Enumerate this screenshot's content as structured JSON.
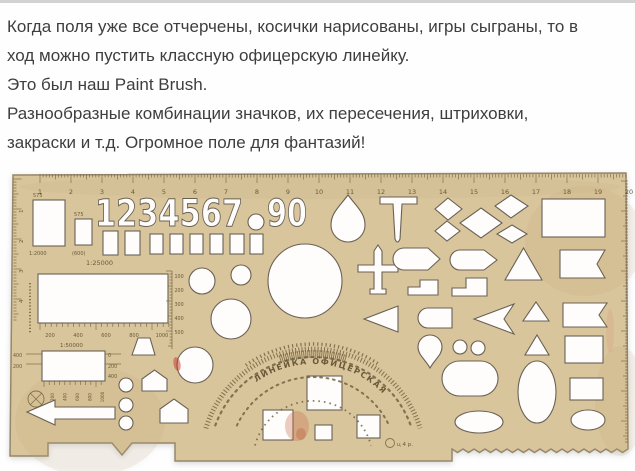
{
  "article": {
    "lines": [
      "Когда поля уже все отчерчены, косички нарисованы, игры сыграны, то в",
      "ход можно пустить классную офицерскую линейку.",
      "Это был наш Paint Brush.",
      "Разнообразные комбинации значков, их пересечения, штриховки,",
      "закраски и т.д. Огромное поле для фантазий!"
    ]
  },
  "stencil": {
    "colors": {
      "plastic": "#d9c59c",
      "plastic_edge": "#97876a",
      "cutout": "#fefdfb",
      "cutout_stroke": "#6a6155",
      "engraving": "#6d5d3c",
      "stain_red": "#c96a4a"
    },
    "arc_title": "ЛИНЕЙКА  ОФИЦЕРСКАЯ",
    "price_mark": "ц 4 р.",
    "body_path": "M13,4 L626,2 L628,278 l-5.5,3.5 l-5.5,-3.5 l-5.5,3.5 l-5.5,-3.5 l-5.5,3.5 l-5.5,-3.5 l-5.5,3.5 l-5.5,-3.5 l-5.5,3.5 l-5.5,-3.5 l-5.5,3.5 l-5.5,-3.5 l-5.5,3.5 l-5.5,-3.5 l-5.5,3.5 l-5.5,-3.5 l-5.5,3.5 l-5.5,-3.5 l-5.5,3.5 l-5.5,-3.5 l-5.5,3.5 l-5.5,-3.5 l-5.5,3.5 l-5.5,-3.5 l-5.5,3.5 l-5.5,-3.5 l-5.5,3.5 l-5.5,-3.5 l-5.5,3.5 l-5.5,-3.5 l-5.5,3.5 l-5.5,-3.5 L452,290 L175,290 L175,272 L132,272 L122,284 L112,272 L48,272 L48,285 L10,285 Z",
    "shading": [
      {
        "cx": 90,
        "cy": 250,
        "rx": 75,
        "ry": 55,
        "f": "#c2a878",
        "o": 0.15
      },
      {
        "cx": 585,
        "cy": 70,
        "rx": 60,
        "ry": 55,
        "f": "#c2a878",
        "o": 0.15
      },
      {
        "cx": 320,
        "cy": 16,
        "rx": 300,
        "ry": 12,
        "f": "#bfa678",
        "o": 0.12
      },
      {
        "cx": 620,
        "cy": 230,
        "rx": 25,
        "ry": 55,
        "f": "#c2a878",
        "o": 0.15
      }
    ],
    "cutouts": [
      {
        "t": "rect",
        "n": "window-large",
        "x": 33,
        "y": 29,
        "w": 32,
        "h": 46
      },
      {
        "t": "rect",
        "n": "window-small",
        "x": 75,
        "y": 48,
        "w": 17,
        "h": 26
      },
      {
        "t": "text",
        "n": "digits-1-7",
        "x": 95,
        "y": 55,
        "s": 37,
        "tl": 148,
        "str": "1234567"
      },
      {
        "t": "circle",
        "n": "degree-circle",
        "cx": 256,
        "cy": 51,
        "r": 8
      },
      {
        "t": "text",
        "n": "digits-9-0",
        "x": 267,
        "y": 55,
        "s": 37,
        "tl": 40,
        "str": "90"
      },
      {
        "t": "rect",
        "x": 103,
        "y": 60,
        "w": 15,
        "h": 24
      },
      {
        "t": "rect",
        "x": 125,
        "y": 60,
        "w": 15,
        "h": 24
      },
      {
        "t": "rect",
        "x": 150,
        "y": 63,
        "w": 13,
        "h": 20
      },
      {
        "t": "rect",
        "x": 170,
        "y": 63,
        "w": 13,
        "h": 20
      },
      {
        "t": "rect",
        "x": 190,
        "y": 63,
        "w": 13,
        "h": 20
      },
      {
        "t": "rect",
        "x": 210,
        "y": 63,
        "w": 13,
        "h": 20
      },
      {
        "t": "rect",
        "x": 230,
        "y": 63,
        "w": 14,
        "h": 20
      },
      {
        "t": "rect",
        "x": 250,
        "y": 63,
        "w": 13,
        "h": 20
      },
      {
        "t": "rect",
        "n": "map-frame-25000",
        "x": 38,
        "y": 103,
        "w": 130,
        "h": 49
      },
      {
        "t": "rect",
        "n": "map-frame-50000",
        "x": 42,
        "y": 180,
        "w": 63,
        "h": 30
      },
      {
        "t": "poly",
        "n": "arrow-left",
        "pts": "27,241 55,229 55,236 115,236 115,248 55,248 55,254"
      },
      {
        "t": "circle",
        "cx": 126,
        "cy": 214,
        "r": 7
      },
      {
        "t": "circle",
        "cx": 126,
        "cy": 234,
        "r": 7
      },
      {
        "t": "circle",
        "cx": 126,
        "cy": 252,
        "r": 7
      },
      {
        "t": "poly",
        "n": "trapezoid",
        "pts": "138,167 150,167 155,184 132,184"
      },
      {
        "t": "poly",
        "n": "house-small",
        "pts": "142,208 154.5,199 167,208 167,220 142,220"
      },
      {
        "t": "poly",
        "n": "house-large",
        "pts": "160,238 174,228 188,238 188,252 160,252"
      },
      {
        "t": "circle",
        "cx": 195,
        "cy": 194,
        "r": 18
      },
      {
        "t": "circle",
        "cx": 202,
        "cy": 110,
        "r": 13
      },
      {
        "t": "circle",
        "cx": 241,
        "cy": 104,
        "r": 10
      },
      {
        "t": "circle",
        "cx": 231,
        "cy": 148,
        "r": 20
      },
      {
        "t": "circle",
        "n": "circle-large",
        "cx": 305,
        "cy": 110,
        "r": 37
      },
      {
        "t": "path",
        "n": "teardrop-up",
        "d": "M348,24 C339,36 331,42 331,54 A17,17 0 1 0 365,54 C365,42 357,36 348,24 Z"
      },
      {
        "t": "path",
        "n": "t-mark",
        "d": "M380,26 H417 V33 H402 L400,68 Q397.5,74 395,68 L393,33 H380 Z"
      },
      {
        "t": "poly",
        "n": "diamond",
        "pts": "448,27 462,38 448,49 435,38"
      },
      {
        "t": "poly",
        "n": "diamond",
        "pts": "447,50 460,60 447,70 435,60"
      },
      {
        "t": "poly",
        "n": "diamond-large",
        "pts": "481,37 502,52 481,67 460,52"
      },
      {
        "t": "poly",
        "n": "diamond",
        "pts": "511,24 528,35 511,47 495,35"
      },
      {
        "t": "poly",
        "n": "diamond",
        "pts": "512,54 527,63 512,72 497,63"
      },
      {
        "t": "rect",
        "n": "rect-large-right",
        "x": 542,
        "y": 28,
        "w": 63,
        "h": 38
      },
      {
        "t": "path",
        "n": "airplane",
        "d": "M378,74 L382,80 L382,94 L398,94 L398,101 L382,101 L382,118 L386,118 L386,123 L370,123 L370,118 L374,118 L374,101 L358,101 L358,94 L374,94 L374,80 Z"
      },
      {
        "t": "path",
        "n": "bullet",
        "d": "M404,77 A11,11 0 0 0 404,99 H428 L440,88 L428,77 Z"
      },
      {
        "t": "path",
        "n": "bullet",
        "d": "M460,79 A10,10 0 0 0 460,99 H484 L497,89 L484,79 Z"
      },
      {
        "t": "poly",
        "n": "triangle-up",
        "pts": "523.5,77 542,109 505,109"
      },
      {
        "t": "path",
        "n": "flag-notched",
        "d": "M560,79 H605 L597,93 L605,107 H560 Z"
      },
      {
        "t": "path",
        "n": "step-shape",
        "d": "M408,124 V116 H420 V109 H438 V124 Z"
      },
      {
        "t": "path",
        "n": "step-shape",
        "d": "M452,125 V117 H466 V107 H487 V125 Z"
      },
      {
        "t": "poly",
        "n": "triangle-small",
        "pts": "536,131 549,150 523,150"
      },
      {
        "t": "path",
        "n": "flag-notched",
        "d": "M563,132 H607 L599,144 L607,156 H563 Z"
      },
      {
        "t": "poly",
        "n": "triangle-left",
        "pts": "364,148 398,135 398,161"
      },
      {
        "t": "path",
        "n": "pill",
        "d": "M428,137 H452 V157 H428 A10,10 0 0 1 428,137 Z"
      },
      {
        "t": "path",
        "n": "dart-left",
        "d": "M474,148 L514,133 L504,148 L514,163 Z"
      },
      {
        "t": "path",
        "n": "teardrop-down",
        "d": "M430,197 C425,188 418,184 418,176 A12,12 0 1 1 442,176 C442,184 435,188 430,197 Z"
      },
      {
        "t": "circle",
        "cx": 460,
        "cy": 176,
        "r": 7
      },
      {
        "t": "circle",
        "cx": 478,
        "cy": 177,
        "r": 7
      },
      {
        "t": "poly",
        "n": "triangle-small",
        "pts": "537,164 549,184 525,184"
      },
      {
        "t": "rect",
        "x": 565,
        "y": 165,
        "w": 38,
        "h": 27
      },
      {
        "t": "rect",
        "n": "stadium",
        "x": 442,
        "y": 190,
        "w": 56,
        "h": 35,
        "rx": 17.5
      },
      {
        "t": "ellipse",
        "n": "ellipse-tall",
        "cx": 537,
        "cy": 221,
        "rx": 19,
        "ry": 31
      },
      {
        "t": "rect",
        "x": 570,
        "y": 207,
        "w": 33,
        "h": 22
      },
      {
        "t": "ellipse",
        "cx": 479,
        "cy": 251,
        "rx": 24,
        "ry": 11
      },
      {
        "t": "ellipse",
        "cx": 588,
        "cy": 249,
        "rx": 17,
        "ry": 10
      },
      {
        "t": "rect",
        "n": "square",
        "x": 307,
        "y": 205,
        "w": 35,
        "h": 34
      },
      {
        "t": "rect",
        "n": "square",
        "x": 263,
        "y": 239,
        "w": 30,
        "h": 30
      },
      {
        "t": "rect",
        "n": "square-tiny",
        "x": 315,
        "y": 254,
        "w": 17,
        "h": 15
      },
      {
        "t": "rect",
        "n": "square",
        "x": 357,
        "y": 244,
        "w": 23,
        "h": 23
      }
    ],
    "marks": [
      {
        "t": "ticks",
        "o": "h",
        "x": 40,
        "y": 3,
        "n": 190,
        "step": 3.1,
        "l1": 3.5,
        "l2": 5.5,
        "l3": 9,
        "n2": "top-ruler-ticks"
      },
      {
        "t": "numrow",
        "n": "top-ruler-numbers",
        "x0": 40,
        "dx": 31,
        "y": 23,
        "s": 6.5,
        "vals": [
          "1",
          "2",
          "3",
          "4",
          "5",
          "6",
          "7",
          "8",
          "9",
          "10",
          "11",
          "12",
          "13",
          "14",
          "15",
          "16",
          "17",
          "18",
          "19",
          "20"
        ]
      },
      {
        "t": "ticks",
        "o": "v",
        "x": 13.5,
        "y": 8,
        "n": 48,
        "step": 3,
        "dir": "r",
        "l1": 3,
        "l2": 5,
        "l3": 8
      },
      {
        "t": "numcol",
        "n": "left-ruler-numbers",
        "x": 23,
        "y0": 42,
        "dy": 30,
        "s": 5.5,
        "rot": -90,
        "vals": [
          "1",
          "2",
          "3",
          "4"
        ]
      },
      {
        "t": "ticks",
        "o": "v",
        "x": 628,
        "y": 10,
        "n": 88,
        "step": 3,
        "dir": "l",
        "l1": 3,
        "l2": 5,
        "l3": 7
      },
      {
        "t": "text",
        "x": 33,
        "y": 26,
        "s": 5,
        "str": "575"
      },
      {
        "t": "text",
        "x": 74,
        "y": 45,
        "s": 5,
        "str": "575"
      },
      {
        "t": "text",
        "n": "scale-label",
        "x": 29,
        "y": 84,
        "s": 5,
        "str": "1:2000"
      },
      {
        "t": "text",
        "x": 72,
        "y": 84,
        "s": 5,
        "str": "(600)"
      },
      {
        "t": "text",
        "n": "scale-label",
        "x": 86,
        "y": 94,
        "s": 6.5,
        "str": "1:25000"
      },
      {
        "t": "ticks",
        "o": "h",
        "x": 40,
        "y": 152,
        "n": 24,
        "step": 5.6,
        "l1": 4,
        "l2": 4,
        "l3": 7
      },
      {
        "t": "numrow",
        "n": "meter-scale",
        "x0": 50,
        "dx": 28,
        "y": 166,
        "s": 5,
        "vals": [
          "200",
          "400",
          "600",
          "800",
          "1000"
        ]
      },
      {
        "t": "text",
        "n": "scale-label",
        "x": 60,
        "y": 176,
        "s": 5.5,
        "str": "1:50000"
      },
      {
        "t": "line",
        "d": "M172,100 V178"
      },
      {
        "t": "ticks",
        "o": "v",
        "x": 172,
        "y": 100,
        "n": 26,
        "step": 3,
        "dir": "l",
        "l1": 2.5,
        "l2": 4,
        "l3": 6
      },
      {
        "t": "numcol",
        "n": "vertical-scale",
        "x": 174.5,
        "y0": 107,
        "dy": 14,
        "s": 4.8,
        "vals": [
          "100",
          "200",
          "300",
          "400",
          "500"
        ]
      },
      {
        "t": "text",
        "x": 13,
        "y": 186,
        "s": 4.8,
        "str": "400"
      },
      {
        "t": "text",
        "x": 13,
        "y": 197,
        "s": 4.8,
        "str": "200"
      },
      {
        "t": "text",
        "x": 108,
        "y": 186,
        "s": 4.8,
        "str": "0"
      },
      {
        "t": "text",
        "x": 108,
        "y": 197,
        "s": 4.8,
        "str": "200"
      },
      {
        "t": "text",
        "x": 108,
        "y": 207,
        "s": 4.8,
        "str": "400"
      },
      {
        "t": "line",
        "d": "M26,183 H42 M26,193 H42 M105,183 H121 M105,193 H121"
      },
      {
        "t": "ticks",
        "o": "h",
        "x": 44,
        "y": 210,
        "n": 12,
        "step": 5.2,
        "l1": 4,
        "l2": 4,
        "l3": 6
      },
      {
        "t": "numrow",
        "n": "meter-scale-rotated",
        "x0": 54,
        "dx": 12.5,
        "y": 226,
        "s": 4.2,
        "rot": -90,
        "vals": [
          "200",
          "400",
          "600",
          "800",
          "1000"
        ]
      },
      {
        "t": "ring",
        "n": "crossed-circle-symbol",
        "cx": 36,
        "cy": 228,
        "r": 8
      },
      {
        "t": "line",
        "d": "M30.5,222.5 L41.5,233.5 M41.5,222.5 L30.5,233.5"
      },
      {
        "t": "line",
        "d": "M30,112 V162",
        "dash": "1.2 2",
        "sw": 2
      },
      {
        "t": "arc",
        "n": "protractor-tick-arc",
        "cx": 313,
        "cy": 290,
        "r": 112,
        "a0": 197,
        "a1": 343,
        "sw": 5,
        "dash": "1 2.2"
      },
      {
        "t": "arc",
        "n": "protractor-dot-arc",
        "cx": 313,
        "cy": 290,
        "r": 104,
        "a0": 200,
        "a1": 340,
        "sw": 2.2,
        "dash": "2 4.6",
        "cap": "round"
      },
      {
        "t": "arc",
        "n": "protractor-crest",
        "cx": 313,
        "cy": 290,
        "r": 107,
        "a0": 252,
        "a1": 288,
        "sw": 8,
        "dash": "0.9 1.1"
      },
      {
        "t": "arc",
        "n": "protractor-outer-arc",
        "cx": 313,
        "cy": 290,
        "r": 117,
        "a0": 235,
        "a1": 305,
        "sw": 3.5,
        "dash": "1.2 3"
      },
      {
        "t": "arc",
        "n": "protractor-dot-arc",
        "cx": 313,
        "cy": 290,
        "r": 84,
        "a0": 205,
        "a1": 335,
        "sw": 2,
        "dash": "1.8 4.6",
        "cap": "round"
      },
      {
        "t": "arc",
        "n": "protractor-inner-arc",
        "cx": 313,
        "cy": 290,
        "r": 60,
        "a0": 195,
        "a1": 345,
        "sw": 1.8,
        "dash": "1.6 4"
      },
      {
        "t": "textarc",
        "n": "ruler-title-arc",
        "cx": 313,
        "cy": 290,
        "r": 97,
        "a0": 233,
        "a1": 315,
        "s": 8,
        "bind": "arc_title"
      },
      {
        "t": "ring",
        "n": "factory-logo",
        "cx": 390,
        "cy": 272,
        "r": 4.5
      },
      {
        "t": "text",
        "n": "price-mark",
        "x": 397,
        "y": 275,
        "s": 5.5,
        "bind": "price_mark"
      },
      {
        "t": "stain",
        "n": "ink-stain",
        "cx": 177,
        "cy": 193,
        "rx": 3.5,
        "ry": 7,
        "f": "#c53526",
        "o": 0.5,
        "rot": -12
      },
      {
        "t": "stain",
        "n": "ink-stain",
        "cx": 297,
        "cy": 255,
        "rx": 12,
        "ry": 15,
        "f": "#c96a4a",
        "o": 0.33
      },
      {
        "t": "stain",
        "n": "ink-stain",
        "cx": 301,
        "cy": 263,
        "rx": 5,
        "ry": 6,
        "f": "#b94f32",
        "o": 0.3
      },
      {
        "t": "stain",
        "n": "ink-stain",
        "cx": 610,
        "cy": 160,
        "rx": 4,
        "ry": 22,
        "f": "#d98a7a",
        "o": 0.2
      }
    ]
  }
}
